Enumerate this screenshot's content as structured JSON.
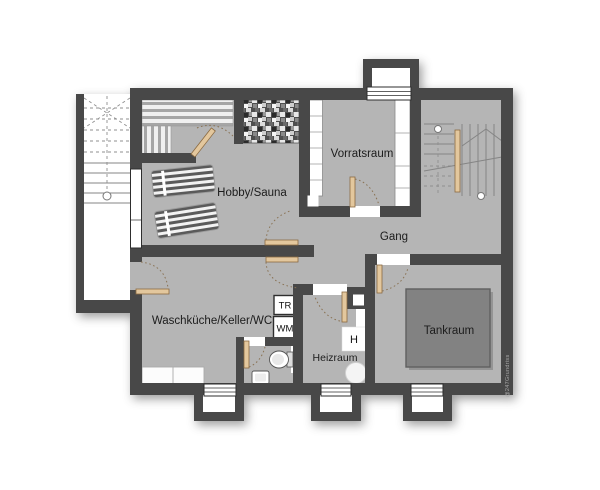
{
  "rooms": {
    "hobby_sauna": "Hobby/Sauna",
    "vorratsraum": "Vorratsraum",
    "gang": "Gang",
    "waschkueche": "Waschküche/Keller/WC",
    "heizraum": "Heizraum",
    "tankraum": "Tankraum"
  },
  "fixtures": {
    "dryer": "TR",
    "washer": "WM",
    "heater": "H"
  },
  "watermark": "@247Grundriss",
  "colors": {
    "background": "#ffffff",
    "floor": "#b5b5b5",
    "wall": "#484848",
    "tank": "#828282",
    "door_wood": "#e3c79d",
    "label_text": "#1c1c1c"
  }
}
